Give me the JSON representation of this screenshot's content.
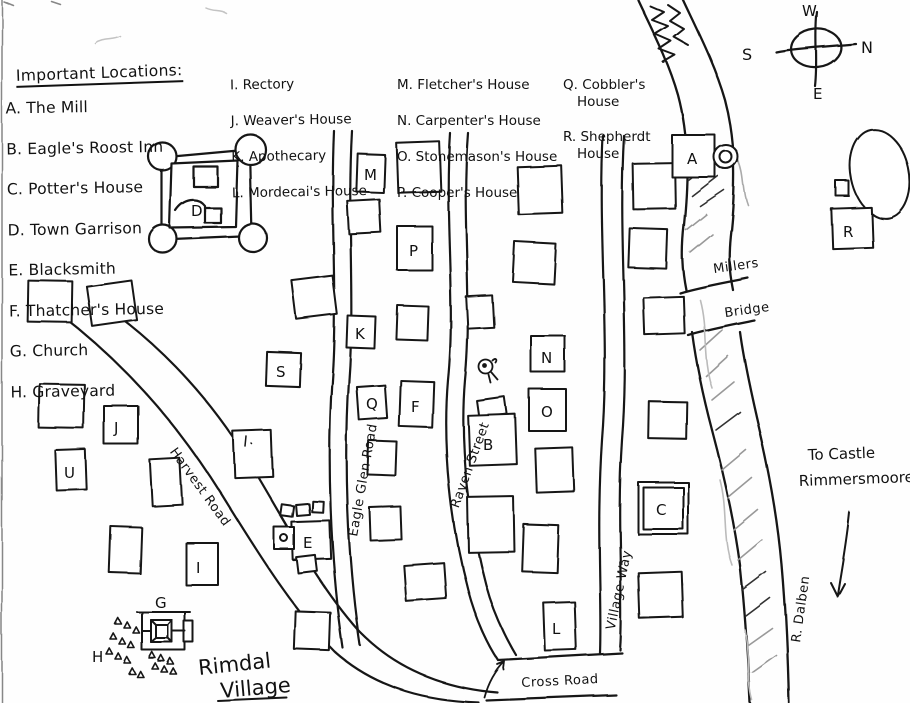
{
  "page": {
    "title_line1": "Rimdal",
    "title_line2": "Village"
  },
  "legend": {
    "heading": "Important Locations:",
    "col1": [
      "A. The Mill",
      "B. Eagle's Roost Inn",
      "C. Potter's House",
      "D. Town Garrison",
      "E. Blacksmith",
      "F. Thatcher's House",
      "G. Church",
      "H. Graveyard"
    ],
    "col2": [
      "I. Rectory",
      "J. Weaver's House",
      "K. Apothecary",
      "L. Mordecai's House"
    ],
    "col3": [
      "M. Fletcher's House",
      "N. Carpenter's House",
      "O. Stonemason's House",
      "P. Cooper's House"
    ],
    "col4": [
      "Q. Cobbler's House",
      "R. Shepherdt House"
    ]
  },
  "compass": {
    "top": "W",
    "right": "N",
    "left": "S",
    "bottom": "E"
  },
  "roads": {
    "harvest": "Harvest Road",
    "eagle_glen": "Eagle Glen Road",
    "raven": "Raven Street",
    "village_way": "Village Way",
    "cross": "Cross Road"
  },
  "river": {
    "name": "R. Dalben",
    "bridge_top": "Millers",
    "bridge_bottom": "Bridge"
  },
  "notes": {
    "castle_line1": "To Castle",
    "castle_line2": "Rimmersmoore"
  },
  "map_letters": {
    "mill": "A",
    "eagles_roost": "B",
    "potter": "C",
    "garrison": "D",
    "blacksmith": "E",
    "thatcher": "F",
    "church": "G",
    "graveyard": "H",
    "rectory": "I",
    "weaver": "J",
    "apothecary": "K",
    "mordecai": "L",
    "fletcher": "M",
    "carpenter": "N",
    "stonemason": "O",
    "cooper": "P",
    "cobbler": "Q",
    "shepherd": "R",
    "s_building": "S",
    "u_building": "U"
  },
  "ink_color": "#161616"
}
